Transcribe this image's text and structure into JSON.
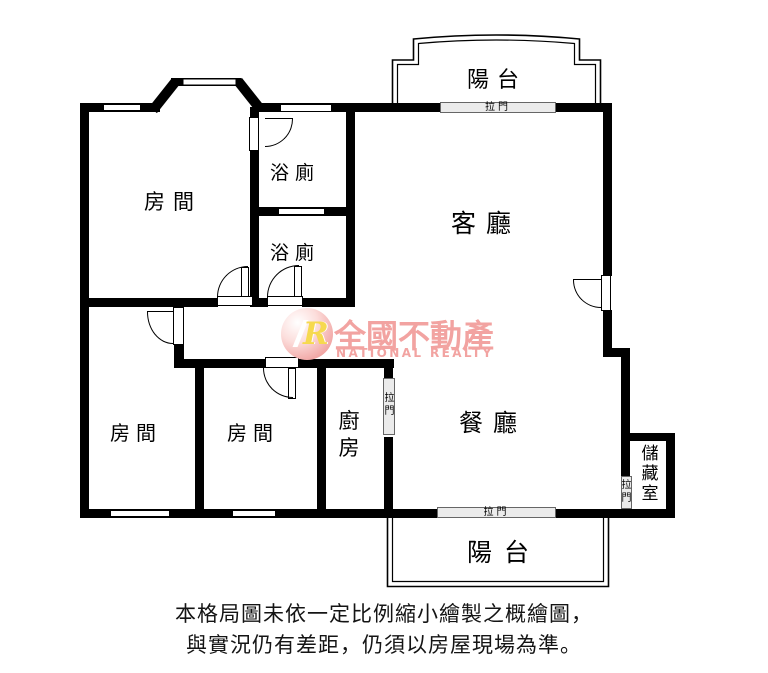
{
  "floorplan": {
    "rooms": {
      "bedroom_top": "房間",
      "bedroom_left": "房間",
      "bedroom_mid": "房間",
      "bath_upper": "浴廁",
      "bath_lower": "浴廁",
      "living": "客廳",
      "dining": "餐廳",
      "kitchen": "廚房",
      "storage": "儲藏室",
      "balcony_top": "陽台",
      "balcony_bottom": "陽台"
    },
    "sliding_door_label": "拉門"
  },
  "logo": {
    "monogram": "R",
    "brand": "全國不動產",
    "subtitle": "NATIONAL REALTY",
    "pink": "#f2a3a1",
    "yellow": "#f6d94f"
  },
  "disclaimer": {
    "line1": "本格局圖未依一定比例縮小繪製之概繪圖，",
    "line2": "與實況仍有差距，仍須以房屋現場為準。"
  }
}
